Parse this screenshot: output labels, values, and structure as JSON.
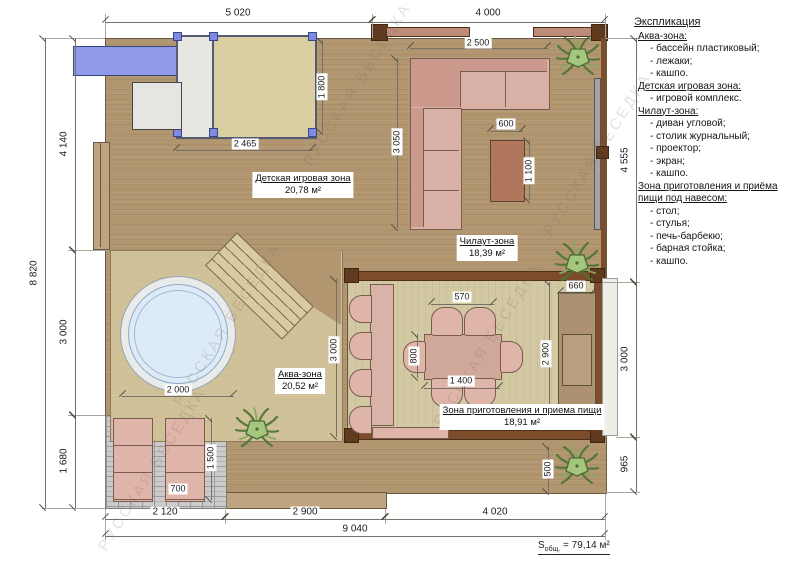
{
  "plan": {
    "watermark": "РУССКАЯ БЕСЕДКА",
    "zones": {
      "kids": {
        "name": "Детская игровая зона",
        "area": "20,78 м²"
      },
      "chill": {
        "name": "Чилаут-зона",
        "area": "18,39 м²"
      },
      "aqua": {
        "name": "Аква-зона",
        "area": "20,52 м²"
      },
      "dining": {
        "name": "Зона приготовления и приема пищи",
        "area": "18,91 м²"
      }
    },
    "dims": {
      "top_left": "5 020",
      "top_right": "4 000",
      "left_total": "8 820",
      "left_1": "4 140",
      "left_2": "3 000",
      "left_3": "1 680",
      "right_1": "4 555",
      "right_2": "3 000",
      "right_3": "965",
      "bottom_1": "2 120",
      "bottom_2": "2 900",
      "bottom_3": "4 020",
      "bottom_total": "9 040",
      "kids_w": "2 465",
      "kids_h": "1 800",
      "sofa_w": "2 500",
      "sofa_h": "3 050",
      "ctable_w": "600",
      "ctable_h": "1 100",
      "pool_d": "2 000",
      "chairs_w": "570",
      "table_d": "800",
      "table_w": "1 400",
      "dining_h": "2 900",
      "bbq_w": "660",
      "dining_zone_h": "3 000",
      "lounger_l": "1 500",
      "lounger_w": "700",
      "planter": "500"
    },
    "total": {
      "prefix": "S",
      "sub": "общ.",
      "rest": " = 79,14 м²"
    }
  },
  "legend": {
    "title": "Экспликация",
    "sections": [
      {
        "heading": "Аква-зона:",
        "items": [
          "- бассейн пластиковый;",
          "- лежаки;",
          "- кашпо."
        ]
      },
      {
        "heading": "Детская игровая зона:",
        "items": [
          "- игровой комплекс."
        ]
      },
      {
        "heading": "Чилаут-зона:",
        "items": [
          "- диван угловой;",
          "- столик журнальный;",
          "- проектор;",
          "- экран;",
          "- кашпо."
        ]
      },
      {
        "heading": "Зона приготовления и приёма пищи под навесом:",
        "items": [
          "- стол;",
          "- стулья;",
          "- печь-барбекю;",
          "- барная стойка;",
          "- кашпо."
        ]
      }
    ]
  }
}
